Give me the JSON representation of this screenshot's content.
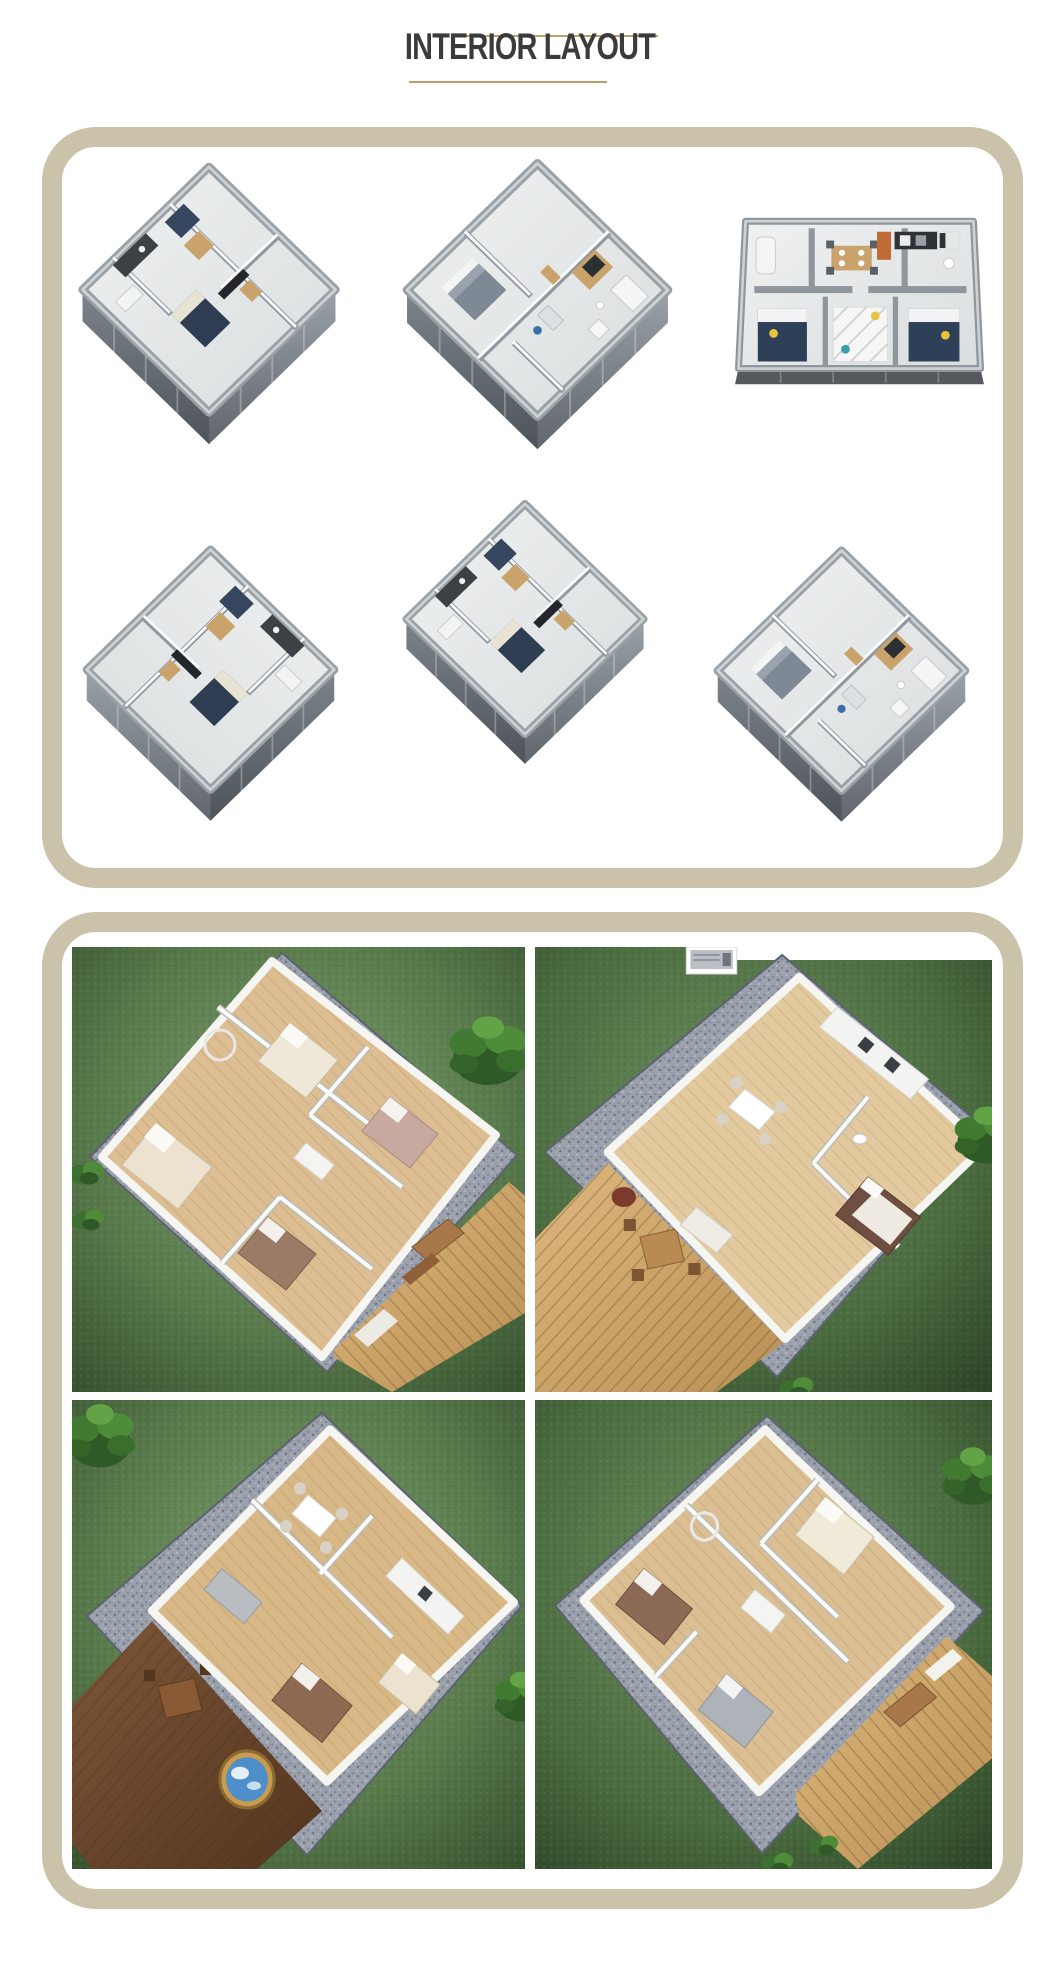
{
  "header": {
    "title": "INTERIOR LAYOUT"
  },
  "theme": {
    "background": "#ffffff",
    "title_text": "#3b3b3d",
    "accent_rule": "#bf9e66",
    "panel_border": "#cac2a9",
    "plan_wall_gray": "#99a0a6",
    "plan_floor": "#e9eceb",
    "grass_green": "#5a7c4d",
    "deck_wood": "#c79b5f",
    "dark_deck_wood": "#6b4730",
    "gravel_gray": "#99a0ab",
    "hot_tub_water": "#4d8ecb",
    "accent_cabinet_tan": "#c9a36b",
    "accent_bed_navy": "#2f3d52"
  },
  "floor_plans_panel": {
    "name": "interior floor plan renders",
    "items": [
      {
        "label": "Isometric 3D floor plan - container home with sofa, dining table, kitchenette and navy bed"
      },
      {
        "label": "Isometric 3D floor plan - container home with central kitchen, bathroom and gray bed"
      },
      {
        "label": "Front cutaway 3D floor plan - two bedrooms with navy beds, dining area and twin bathrooms"
      },
      {
        "label": "Isometric 3D floor plan - container home with bathroom, wardrobe and bathtub"
      },
      {
        "label": "Isometric 3D floor plan - compact container home with desk and kitchenette"
      },
      {
        "label": "Isometric 3D floor plan - container home with desk, blue chair, kitchen and bed"
      }
    ]
  },
  "exterior_panel": {
    "name": "exterior 3D renders",
    "items": [
      {
        "label": "Aerial render - three-bedroom expandable home with timber deck, lawn and palm tree"
      },
      {
        "label": "Aerial render - one-bedroom expandable home with dining set, timber deck and AC unit"
      },
      {
        "label": "Aerial render - expandable home with dark timber deck and round hot tub"
      },
      {
        "label": "Aerial render - two-bedroom expandable home with timber deck and outdoor tables"
      }
    ]
  }
}
